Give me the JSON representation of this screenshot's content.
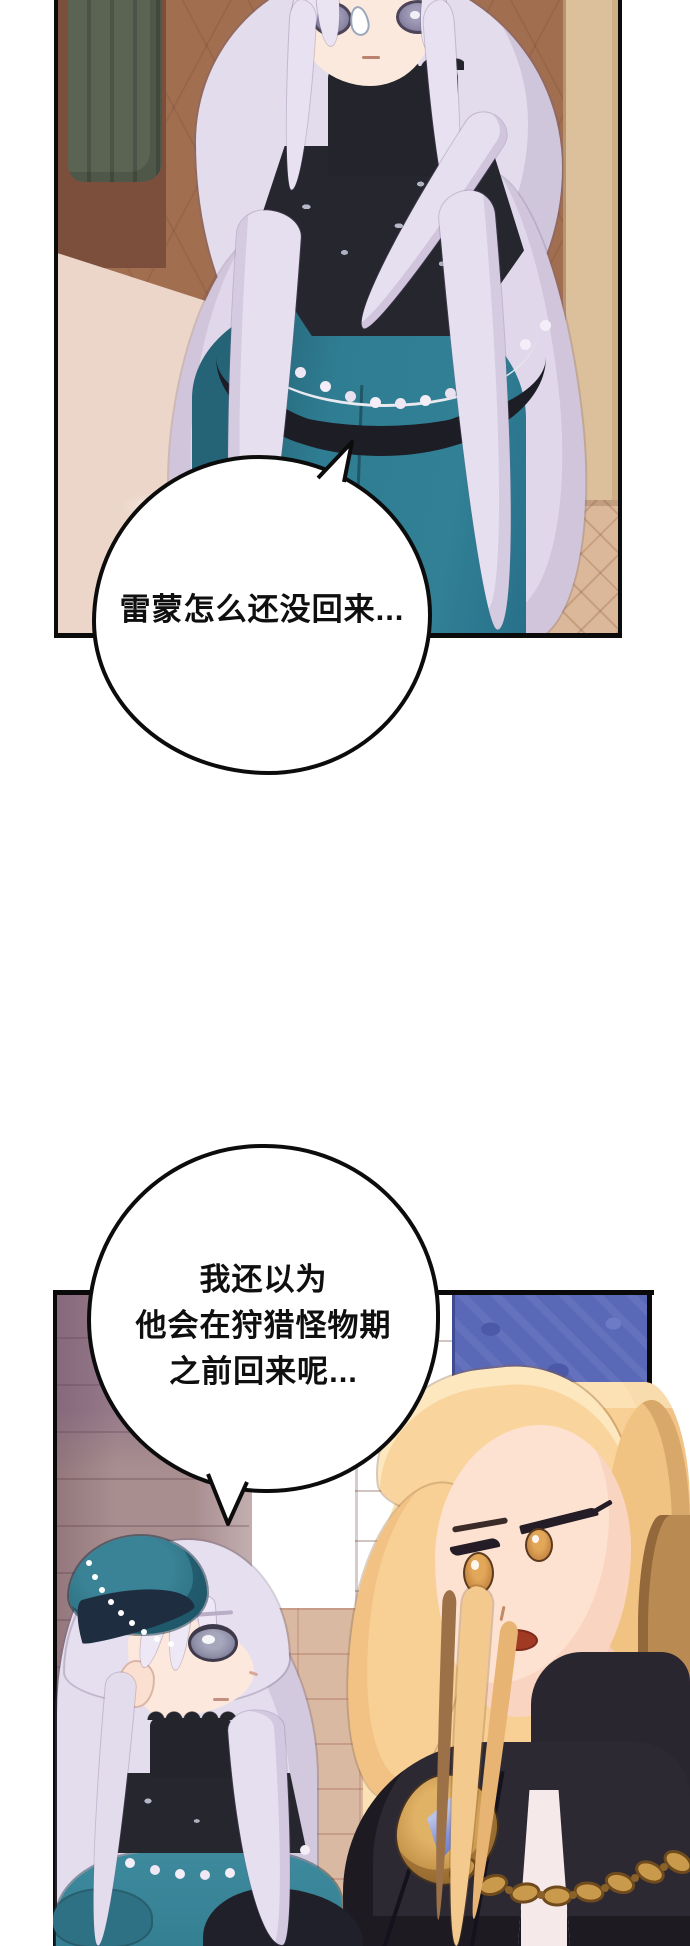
{
  "page": {
    "width": 690,
    "height": 1946,
    "background": "#ffffff",
    "type": "webtoon-comic-page"
  },
  "speech_bubbles": {
    "bubble1": {
      "text": "雷蒙怎么还没回来..."
    },
    "bubble2": {
      "lines": [
        "我还以为",
        "他会在狩猎怪物期",
        "之前回来呢..."
      ]
    }
  },
  "colors": {
    "panel_border": "#0b0b0b",
    "bubble_fill": "#ffffff",
    "bubble_outline": "#0c0c0c",
    "text": "#0f0f0f",
    "top_panel_wall_brown": "#a26e50",
    "top_panel_curtain_green": "#5b6353",
    "girl_dress_teal": "#2f7d92",
    "girl_hair_silver": "#e3dcec",
    "girl_eye_gray_purple": "#8d89a6",
    "lace_black": "#24242c",
    "pearl_white": "#f3eef7",
    "door_frame_tan": "#dcbf9b",
    "sky_blue": "#9fd2ef",
    "stone_pillar_mauve": "#a98e90",
    "wall_tiles_tan": "#d9b9a2",
    "damask_curtain_blue": "#5a68b8",
    "beret_teal": "#2a6c80",
    "blonde_hair_gold": "#f8cf94",
    "blonde_eye_amber": "#c98a45",
    "coat_dark": "#2d2933",
    "shirt_pink_white": "#f6e9ea",
    "gold_chain": "#c99a4b",
    "brooch_gem_blue": "#8391d4"
  }
}
